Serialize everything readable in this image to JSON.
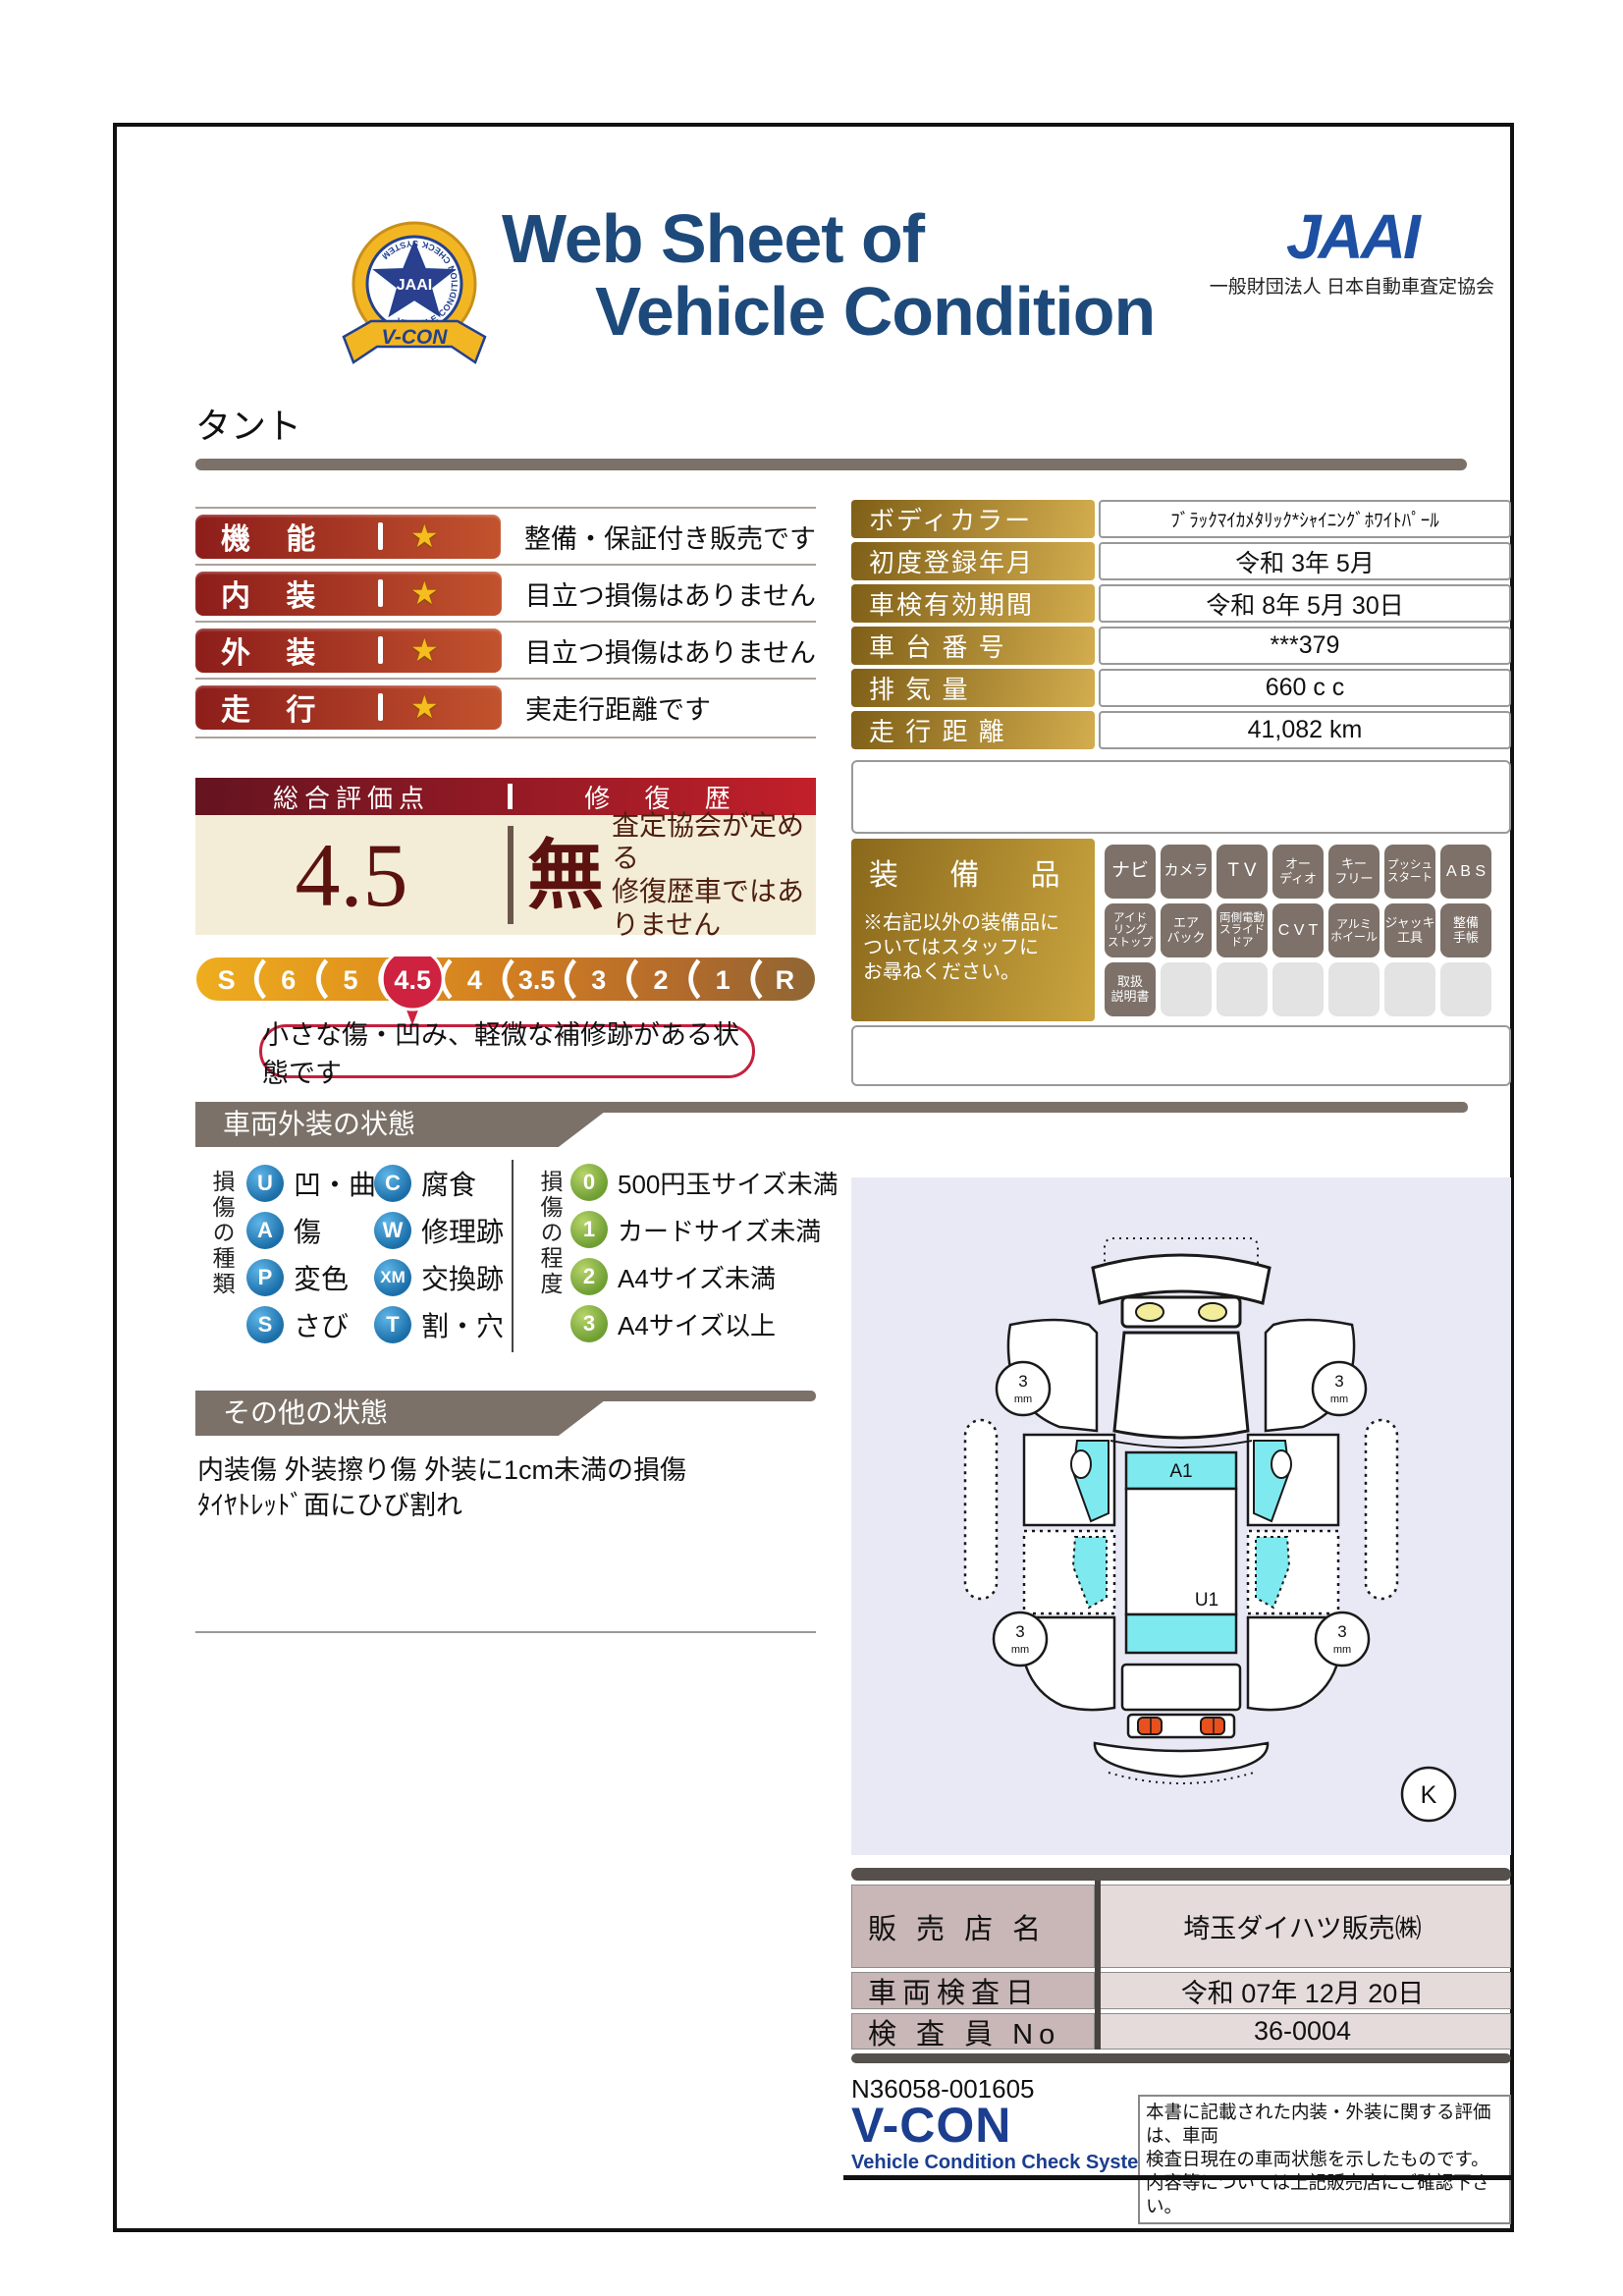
{
  "header": {
    "badge": {
      "ring_text": "VEHICLE CONDITION CHECK SYSTEM",
      "star_text": "JAAI",
      "ribbon_text": "V-CON"
    },
    "title_line1": "Web Sheet of",
    "title_line2": "Vehicle Condition",
    "org_logo": "JAAI",
    "org_name": "一般財団法人 日本自動車査定協会"
  },
  "vehicle_name": "タント",
  "ratings": [
    {
      "label": "機 能",
      "star": "★",
      "comment": "整備・保証付き販売です"
    },
    {
      "label": "内 装",
      "star": "★",
      "comment": "目立つ損傷はありません"
    },
    {
      "label": "外 装",
      "star": "★",
      "comment": "目立つ損傷はありません"
    },
    {
      "label": "走 行",
      "star": "★",
      "comment": "実走行距離です"
    }
  ],
  "overall": {
    "header_left": "総合評価点",
    "header_right": "修 復 歴",
    "score": "4.5",
    "repair": "無",
    "repair_note": "査定協会が定める\n修復歴車ではありません",
    "scale": [
      "S",
      "6",
      "5",
      "4.5",
      "4",
      "3.5",
      "3",
      "2",
      "1",
      "R"
    ],
    "selected": "4.5",
    "callout": "小さな傷・凹み、軽微な補修跡がある状態です"
  },
  "info_table": {
    "rows": [
      {
        "label": "ボディカラー",
        "value": "ﾌﾞﾗｯｸﾏｲｶﾒﾀﾘｯｸ*ｼｬｲﾆﾝｸﾞﾎﾜｲﾄﾊﾟｰﾙ"
      },
      {
        "label": "初度登録年月",
        "value": "令和 3年 5月"
      },
      {
        "label": "車検有効期間",
        "value": "令和 8年 5月 30日"
      },
      {
        "label": "車 台 番 号",
        "value": "***379"
      },
      {
        "label": "排  気  量",
        "value": "660 c c"
      },
      {
        "label": "走 行 距 離",
        "value": "41,082 km"
      }
    ]
  },
  "equipment": {
    "title": "装 備 品",
    "note": "※右記以外の装備品に\nついてはスタッフに\nお尋ねください。",
    "items": [
      {
        "label": "ナビ",
        "filled": true
      },
      {
        "label": "カメラ",
        "filled": true
      },
      {
        "label": "T V",
        "filled": true
      },
      {
        "label": "オー\nディオ",
        "filled": true
      },
      {
        "label": "キー\nフリー",
        "filled": true
      },
      {
        "label": "プッシュ\nスタート",
        "filled": true
      },
      {
        "label": "A B S",
        "filled": true
      },
      {
        "label": "アイド\nリング\nストップ",
        "filled": true
      },
      {
        "label": "エア\nバック",
        "filled": true
      },
      {
        "label": "両側電動\nスライド\nドア",
        "filled": true
      },
      {
        "label": "C V T",
        "filled": true
      },
      {
        "label": "アルミ\nホイール",
        "filled": true
      },
      {
        "label": "ジャッキ\n工具",
        "filled": true
      },
      {
        "label": "整備\n手帳",
        "filled": true
      },
      {
        "label": "取扱\n説明書",
        "filled": true
      },
      {
        "label": "",
        "filled": false
      },
      {
        "label": "",
        "filled": false
      },
      {
        "label": "",
        "filled": false
      },
      {
        "label": "",
        "filled": false
      },
      {
        "label": "",
        "filled": false
      },
      {
        "label": "",
        "filled": false
      }
    ]
  },
  "exterior": {
    "section_title": "車両外装の状態",
    "type_axis": "損傷の種類",
    "types": [
      {
        "code": "U",
        "label": "凹・曲"
      },
      {
        "code": "A",
        "label": "傷"
      },
      {
        "code": "P",
        "label": "変色"
      },
      {
        "code": "S",
        "label": "さび"
      },
      {
        "code": "C",
        "label": "腐食"
      },
      {
        "code": "W",
        "label": "修理跡"
      },
      {
        "code": "XM",
        "label": "交換跡"
      },
      {
        "code": "T",
        "label": "割・穴"
      }
    ],
    "level_axis": "損傷の程度",
    "levels": [
      {
        "code": "0",
        "label": "500円玉サイズ未満"
      },
      {
        "code": "1",
        "label": "カードサイズ未満"
      },
      {
        "code": "2",
        "label": "A4サイズ未満"
      },
      {
        "code": "3",
        "label": "A4サイズ以上"
      }
    ]
  },
  "other": {
    "section_title": "その他の状態",
    "line1": "内装傷 外装擦り傷 外装に1cm未満の損傷",
    "line2": "ﾀｲﾔﾄﾚｯﾄﾞ面にひび割れ"
  },
  "diagram": {
    "hood_label": "A1",
    "roof_label": "U1",
    "tread_value": "3",
    "tread_unit": "mm",
    "grade": "K"
  },
  "dealer": {
    "rows": [
      {
        "label": "販 売 店 名",
        "value": "埼玉ダイハツ販売㈱"
      },
      {
        "label": "車両検査日",
        "value": "令和 07年 12月 20日"
      },
      {
        "label": "検 査 員 No",
        "value": "36-0004"
      }
    ]
  },
  "footer": {
    "serial": "N36058-001605",
    "logo": "V-CON",
    "logo_sub": "Vehicle Condition Check System",
    "note": "本書に記載された内装・外装に関する評価は、車両\n検査日現在の車両状態を示したものです。\n内容等については上記販売店にご確認下さい。"
  }
}
